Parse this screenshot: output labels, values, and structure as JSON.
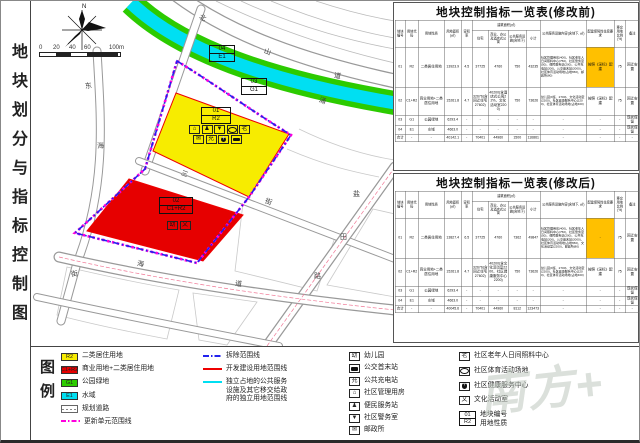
{
  "sidebar": {
    "title": "地块划分与指标控制图",
    "legend_label": "图例"
  },
  "watermark": "南方+",
  "map": {
    "compass_label": "N",
    "scale_labels": [
      "0",
      "20",
      "40",
      "60",
      "100m"
    ],
    "street_labels": [
      {
        "ch": "北",
        "x": 168,
        "y": 12,
        "r": 28
      },
      {
        "ch": "山",
        "x": 233,
        "y": 46,
        "r": 20
      },
      {
        "ch": "道",
        "x": 303,
        "y": 70,
        "r": 12
      },
      {
        "ch": "东",
        "x": 54,
        "y": 80,
        "r": -8
      },
      {
        "ch": "海",
        "x": 66,
        "y": 140,
        "r": -5
      },
      {
        "ch": "街",
        "x": 40,
        "y": 268,
        "r": -10
      },
      {
        "ch": "三",
        "x": 150,
        "y": 168,
        "r": 21
      },
      {
        "ch": "街",
        "x": 234,
        "y": 196,
        "r": 21
      },
      {
        "ch": "盐",
        "x": 322,
        "y": 188,
        "r": 0
      },
      {
        "ch": "田",
        "x": 309,
        "y": 231,
        "r": 0
      },
      {
        "ch": "路",
        "x": 283,
        "y": 270,
        "r": 0
      },
      {
        "ch": "海",
        "x": 106,
        "y": 258,
        "r": 10
      },
      {
        "ch": "道",
        "x": 204,
        "y": 278,
        "r": 8
      },
      {
        "ch": "涌",
        "x": 288,
        "y": 95,
        "r": 20
      }
    ],
    "parcel_labels": [
      {
        "code": "04",
        "use": "E1",
        "x": 178,
        "y": 44,
        "w": 24
      },
      {
        "code": "03",
        "use": "G1",
        "x": 210,
        "y": 77,
        "w": 24
      },
      {
        "code": "01",
        "use": "R2",
        "x": 170,
        "y": 106,
        "w": 28
      },
      {
        "code": "02",
        "use": "C1+R2",
        "x": 128,
        "y": 196,
        "w": 32
      }
    ],
    "p01_icons": [
      [
        "⌂",
        "♟",
        "▼",
        "oval",
        "老"
      ],
      [
        "✉",
        "充",
        "cross",
        "bus"
      ]
    ],
    "p02_icons": [
      "幼",
      "文"
    ]
  },
  "tables": {
    "headers_top": [
      "地块编号",
      "用地代码",
      "用地性质",
      "用地面积(㎡)",
      "容积率",
      "建筑面积(㎡)",
      "公共服务设施内容(含地下, ㎡)",
      "配建保障性住房要求",
      "移交用地比例(%)",
      "备注"
    ],
    "headers_sub": [
      "住宅",
      "商业、办公及酒店式公寓",
      "公共服务设施(含地下)",
      "小计"
    ],
    "before": {
      "title": "地块控制指标一览表(修改前)",
      "rows": [
        [
          "01",
          "R2",
          "二类居住用地",
          "13923.9",
          "4.5",
          "37725",
          "4760",
          "750",
          "43235",
          {
            "t": "社区管理用房(400)、社区老年人日间照料中心(750)、社区警务室(50)、便民服务站(200)、公共充电站(200)、公交首末站(2000)、社区体育活动场地(占地650)、邮政所(80)",
            "cls": "xs"
          },
          {
            "t": "按照《深标》配建",
            "cls": "hl"
          },
          "75",
          "回迁安置"
        ],
        [
          "02",
          "C1+R2",
          "商业用地+二类居住用地",
          "15261.8",
          "4.7",
          "32676(含回迁住宅27602)",
          "40200(含酒店式公寓22%、文化活动室2200)",
          "750",
          "73626",
          {
            "t": "幼儿园(9班、2700)、文化活动室(2200)、社区健康服务中心(2200)、社区体育活动场地(占地400)",
            "cls": "xs"
          },
          "按照《深标》配建",
          "75",
          "回迁安置"
        ],
        [
          "03",
          "G1",
          "公园绿地",
          "6293.4",
          "-",
          "-",
          "-",
          "-",
          "-",
          "-",
          "-",
          "-",
          "现状保留"
        ],
        [
          "04",
          "E1",
          "水域",
          "4663.0",
          "-",
          "-",
          "-",
          "-",
          "-",
          "-",
          "-",
          "-",
          "现状保留"
        ],
        [
          "合计",
          "-",
          "-",
          "40142.1",
          "-",
          "70401",
          "44960",
          "1500",
          "116861",
          "-",
          "-",
          "-",
          "-"
        ]
      ]
    },
    "after": {
      "title": "地块控制指标一览表(修改后)",
      "rows": [
        [
          "01",
          "R2",
          "二类居住用地",
          "13827.4",
          "6.5",
          "37725",
          "4760",
          "7362",
          "49847",
          {
            "t": "社区管理用房(400)、社区老年人日间照料中心(750)、社区警务室(50)、便民服务站(200)、公共充电站(200)、公交首末站(2000)、社区体育活动场地(占地650)、文化活动室(2200)、邮政所(80)",
            "cls": "xs"
          },
          {
            "t": "-",
            "cls": "hl"
          },
          "75",
          "回迁安置"
        ],
        [
          "02",
          "C1+R2",
          "商业用地+二类居住用地",
          "15261.8",
          "4.7",
          "32676(含回迁住宅27602)",
          "40200(含文化活动室2200、社区健康服务中心2200)",
          "750",
          "73626",
          {
            "t": "幼儿园(9班、2700)、文化活动室(2200)、社区健康服务中心(2200)、社区体育活动场地(占地400)",
            "cls": "xs"
          },
          "按照《深标》配建",
          "75",
          "回迁安置"
        ],
        [
          "03",
          "G1",
          "公园绿地",
          "6293.4",
          "-",
          "-",
          "-",
          "-",
          "-",
          "-",
          "-",
          "-",
          "现状保留"
        ],
        [
          "04",
          "E1",
          "水域",
          "4663.0",
          "-",
          "-",
          "-",
          "-",
          "-",
          "-",
          "-",
          "-",
          "现状保留"
        ],
        [
          "合计",
          "-",
          "-",
          "40045.6",
          "-",
          "70401",
          "44960",
          "8112",
          "123473",
          "-",
          "-",
          "-",
          "-"
        ]
      ]
    }
  },
  "legend": {
    "areas": [
      {
        "code": "R2",
        "color": "#f7ec00",
        "label": "二类居住用地"
      },
      {
        "code": "C1+R2",
        "color": "#e60000",
        "label": "商业用地+二类居住用地"
      },
      {
        "code": "G1",
        "color": "#2ccb00",
        "label": "公园绿地"
      },
      {
        "code": "E1",
        "color": "#00dff2",
        "label": "水域"
      },
      {
        "type": "road",
        "code": "",
        "label": "规划道路"
      },
      {
        "type": "magdash",
        "code": "",
        "label": "更新单元范围线"
      }
    ],
    "lines": [
      {
        "style": "bluedash",
        "label": "拆除范围线"
      },
      {
        "style": "redline",
        "label": "开发建设用地范围线"
      },
      {
        "style": "cyanline",
        "label": "独立占地的公共服务\n设施及其它移交给政\n府的独立用地范围线"
      }
    ],
    "icons1": [
      {
        "glyph": "幼",
        "label": "幼儿园"
      },
      {
        "glyph": "bus",
        "label": "公交首末站"
      },
      {
        "glyph": "充",
        "label": "公共充电站"
      },
      {
        "glyph": "⌂",
        "label": "社区管理用房"
      },
      {
        "glyph": "♟",
        "label": "便民服务站"
      },
      {
        "glyph": "▼",
        "label": "社区警务室"
      },
      {
        "glyph": "✉",
        "label": "邮政所"
      }
    ],
    "icons2": [
      {
        "glyph": "老",
        "label": "社区老年人日间照料中心"
      },
      {
        "glyph": "oval",
        "label": "社区体育活动场地"
      },
      {
        "glyph": "cross",
        "label": "社区健康服务中心"
      },
      {
        "glyph": "文",
        "label": "文化活动室"
      },
      {
        "type": "codebox",
        "code": "01",
        "use": "R2",
        "label": "地块编号\n用地性质"
      }
    ]
  }
}
